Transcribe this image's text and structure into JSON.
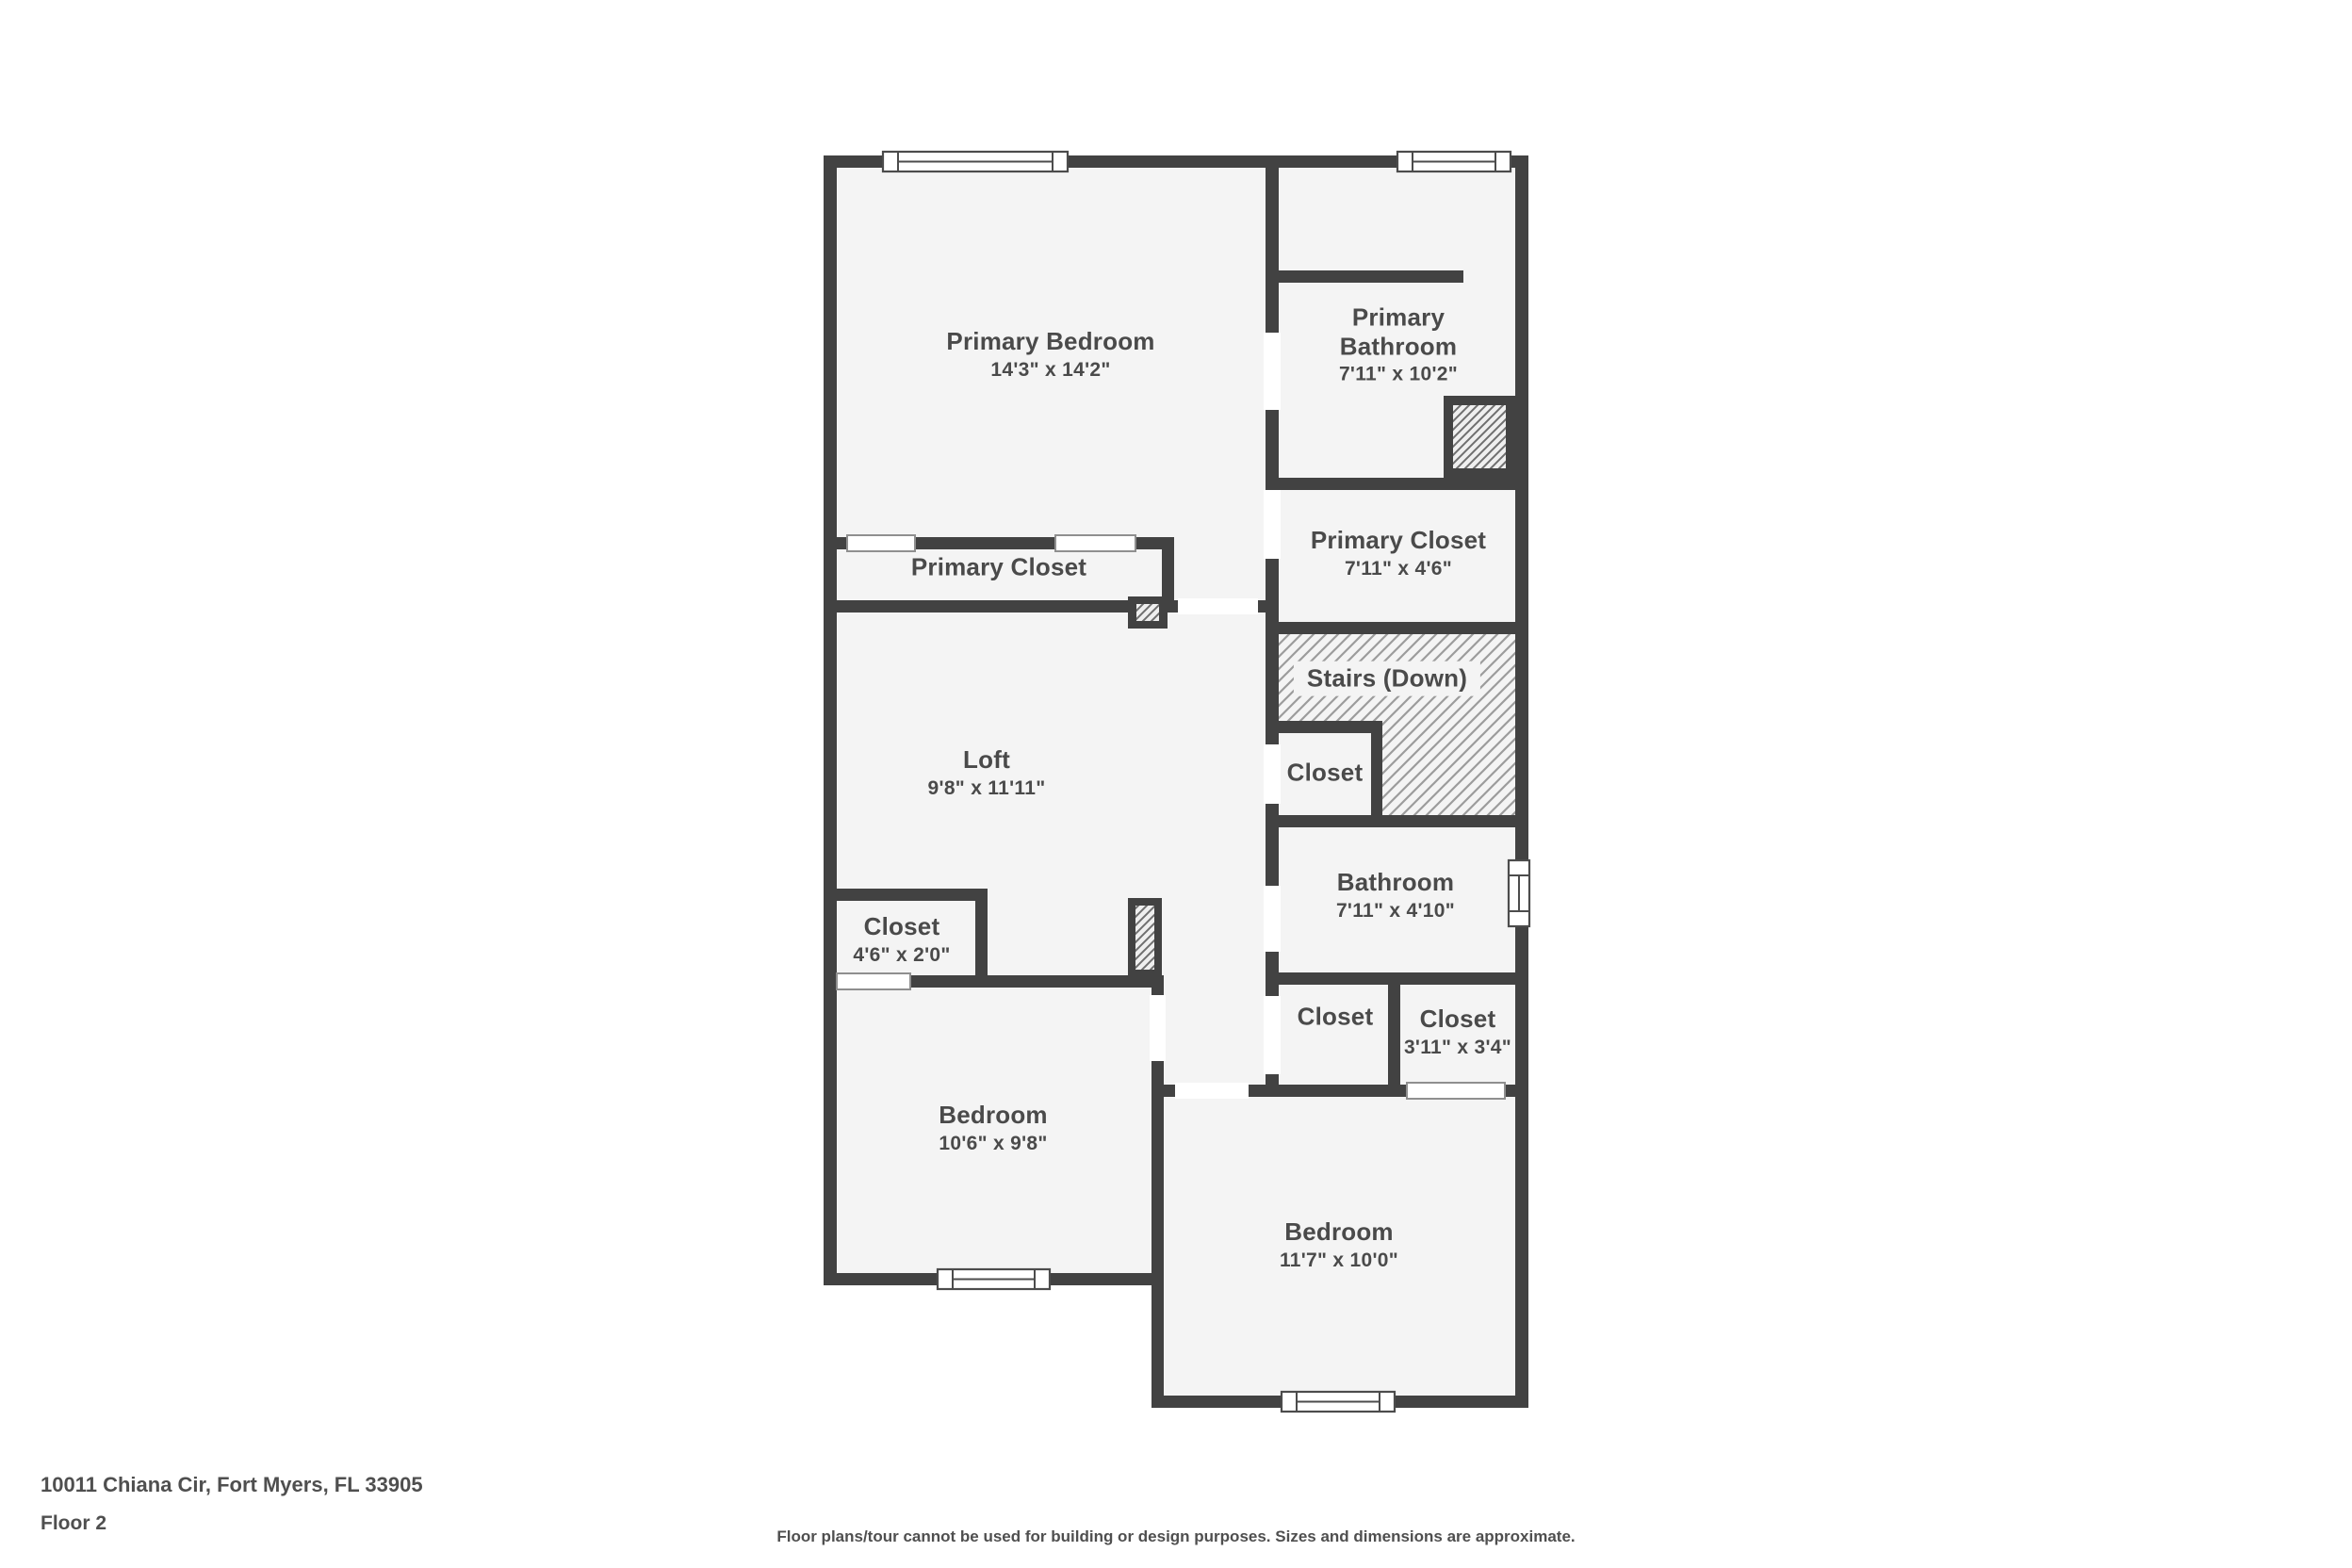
{
  "plan": {
    "colors": {
      "wall": "#424242",
      "floor": "#f4f4f4",
      "hatch_line": "#9c9c9c",
      "label_text": "#4a4a4a"
    },
    "rooms": [
      {
        "id": "primary-bedroom",
        "name": "Primary Bedroom",
        "dims": "14'3\" x 14'2\""
      },
      {
        "id": "primary-bathroom",
        "name": "Primary Bathroom",
        "dims": "7'11\" x 10'2\""
      },
      {
        "id": "primary-closet-left",
        "name": "Primary Closet",
        "dims": ""
      },
      {
        "id": "primary-closet-right",
        "name": "Primary Closet",
        "dims": "7'11\" x 4'6\""
      },
      {
        "id": "stairs-down",
        "name": "Stairs (Down)",
        "dims": ""
      },
      {
        "id": "loft",
        "name": "Loft",
        "dims": "9'8\" x 11'11\""
      },
      {
        "id": "closet-by-stairs",
        "name": "Closet",
        "dims": ""
      },
      {
        "id": "bathroom",
        "name": "Bathroom",
        "dims": "7'11\" x 4'10\""
      },
      {
        "id": "closet-loft",
        "name": "Closet",
        "dims": "4'6\" x 2'0\""
      },
      {
        "id": "closet-hall",
        "name": "Closet",
        "dims": ""
      },
      {
        "id": "closet-bedroom2",
        "name": "Closet",
        "dims": "3'11\" x 3'4\""
      },
      {
        "id": "bedroom-left",
        "name": "Bedroom",
        "dims": "10'6\" x 9'8\""
      },
      {
        "id": "bedroom-right",
        "name": "Bedroom",
        "dims": "11'7\" x 10'0\""
      }
    ]
  },
  "footer": {
    "address": "10011 Chiana Cir, Fort Myers, FL 33905",
    "floor_label": "Floor 2",
    "disclaimer": "Floor plans/tour cannot be used for building or design purposes. Sizes and dimensions are approximate."
  }
}
